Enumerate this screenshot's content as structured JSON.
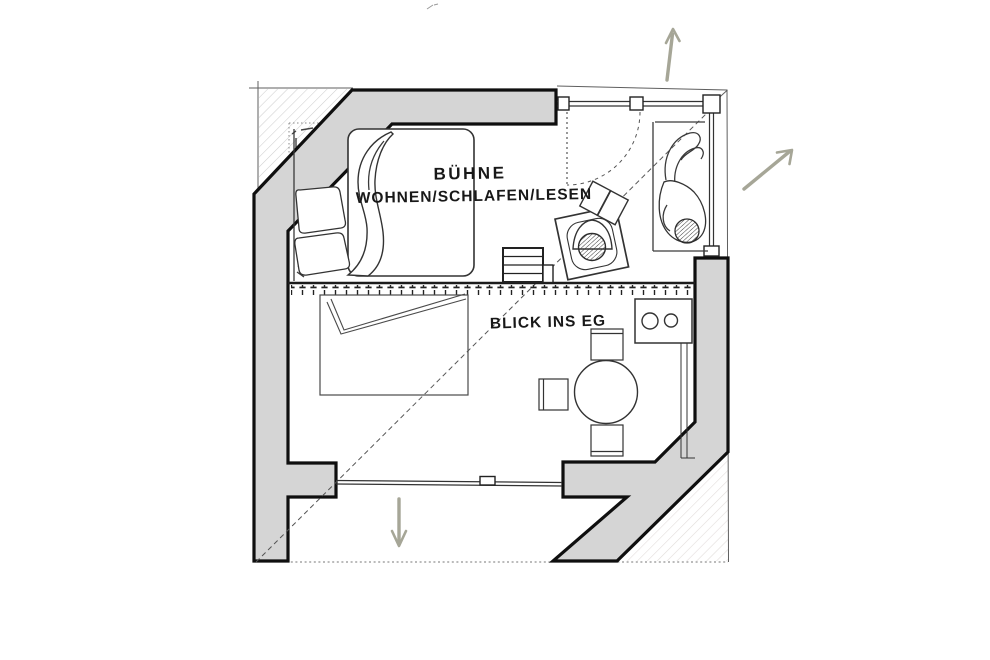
{
  "drawing": {
    "labels": {
      "stage_line1": "BÜHNE",
      "stage_line2": "WOHNEN/SCHLAFEN/LESEN",
      "view_note": "BLICK INS EG"
    },
    "colors": {
      "wall_fill": "#d5d5d5",
      "outline": "#0f0f0f",
      "arrow": "#a6a697",
      "hatch_upper": "#cfcfcf",
      "hatch_lower": "#e2dddb"
    },
    "arrows": [
      {
        "name": "arrow-up",
        "direction": "up"
      },
      {
        "name": "arrow-up-right",
        "direction": "up-right"
      },
      {
        "name": "arrow-down",
        "direction": "down"
      }
    ],
    "elements": [
      "bed",
      "pillows",
      "duvet",
      "reading-armchair",
      "lounging-person",
      "stairs",
      "railing",
      "void-opening",
      "kitchen-cooktop",
      "dining-table",
      "dining-chairs",
      "glass-wall",
      "door-swing",
      "sight-line"
    ]
  }
}
